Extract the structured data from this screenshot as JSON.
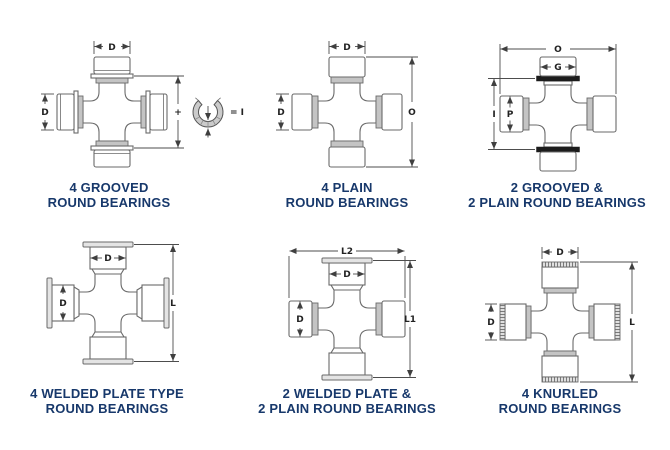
{
  "page": {
    "background": "#ffffff",
    "caption_color": "#17386b",
    "figure_line_color": "#6a6a6a",
    "dimension_line_color": "#4d4d4d",
    "band_gray": "#c4c4c4",
    "groove_ring_black": "#1c1c1c"
  },
  "figures": [
    {
      "name": "4-grooved-round-bearings",
      "caption": [
        "4 GROOVED",
        "ROUND BEARINGS"
      ],
      "labels": {
        "top_width": "D",
        "left_diameter": "D",
        "plus": "+",
        "equals_i": "= I"
      }
    },
    {
      "name": "4-plain-round-bearings",
      "caption": [
        "4 PLAIN",
        "ROUND BEARINGS"
      ],
      "labels": {
        "top_width": "D",
        "left_diameter": "D",
        "overall": "O"
      }
    },
    {
      "name": "2-grooved-2-plain-round-bearings",
      "caption": [
        "2 GROOVED &",
        "2 PLAIN ROUND BEARINGS"
      ],
      "labels": {
        "overall": "O",
        "cap_width": "G",
        "inner_span": "I",
        "cap_diameter": "P"
      }
    },
    {
      "name": "4-welded-plate-type-round-bearings",
      "caption": [
        "4 WELDED PLATE TYPE",
        "ROUND BEARINGS"
      ],
      "labels": {
        "cap_width": "D",
        "cap_diameter": "D",
        "length": "L"
      }
    },
    {
      "name": "2-welded-plate-2-plain-round-bearings",
      "caption": [
        "2 WELDED PLATE &",
        "2 PLAIN ROUND BEARINGS"
      ],
      "labels": {
        "overall_width": "L2",
        "cap_width": "D",
        "cap_diameter": "D",
        "length": "L1"
      }
    },
    {
      "name": "4-knurled-round-bearings",
      "caption": [
        "4 KNURLED",
        "ROUND BEARINGS"
      ],
      "labels": {
        "top_width": "D",
        "left_diameter": "D",
        "length": "L"
      }
    }
  ]
}
